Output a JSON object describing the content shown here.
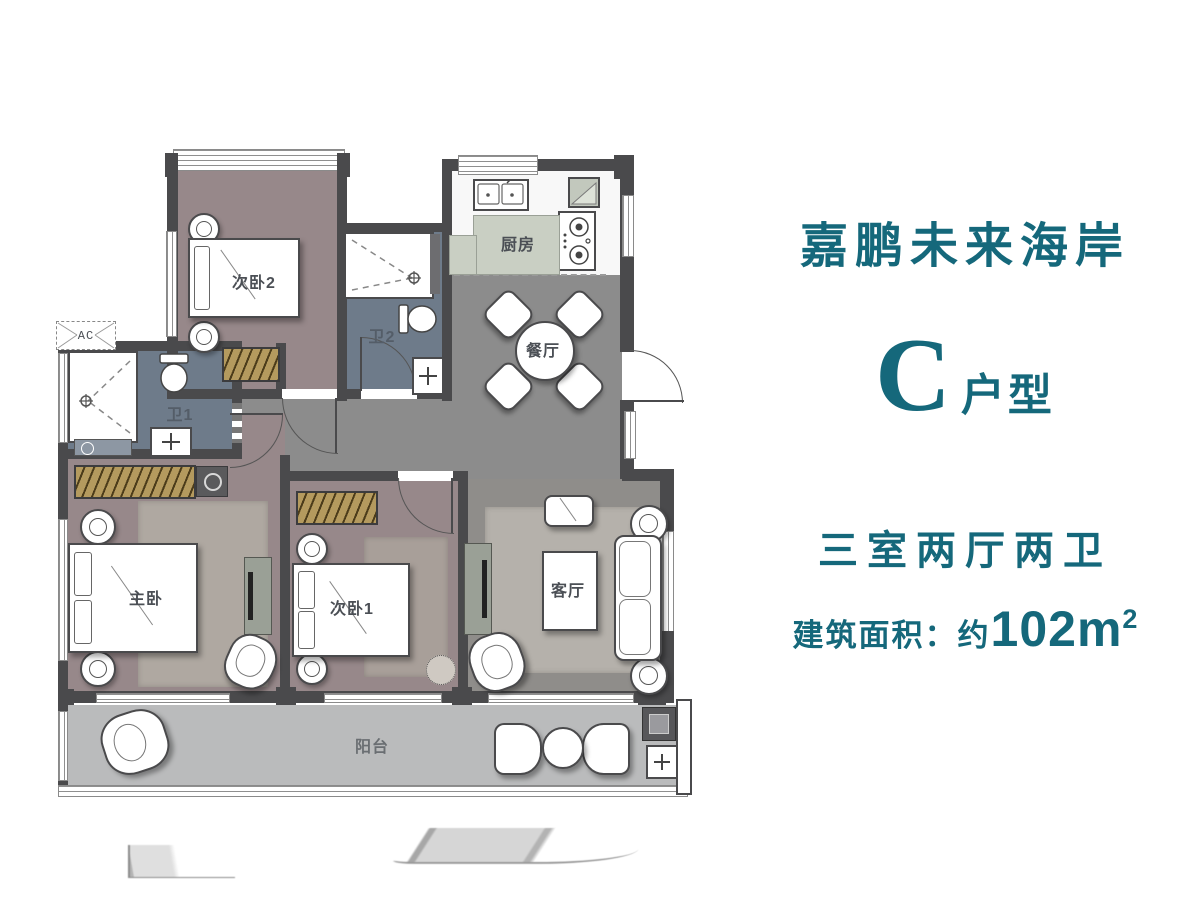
{
  "panel": {
    "project_name": "嘉鹏未来海岸",
    "unit_letter": "C",
    "unit_suffix": "户型",
    "layout_summary": "三室两厅两卫",
    "area_prefix": "建筑面积：约",
    "area_value": "102m",
    "area_sup": "2"
  },
  "rooms": {
    "bedroom2": "次卧2",
    "bath2": "卫2",
    "kitchen": "厨房",
    "dining": "餐厅",
    "bath1": "卫1",
    "master": "主卧",
    "bedroom1": "次卧1",
    "living": "客厅",
    "balcony": "阳台",
    "ac": "AC"
  },
  "colors": {
    "accent_teal": "#15687B",
    "wall": "#4A4A4C",
    "bedroom_floor": "#97888A",
    "corridor_floor": "#8C8C8C",
    "bath_floor": "#6E7B8A",
    "kitchen_counter": "#C9CFC3",
    "balcony_floor": "#BABBBC",
    "wardrobe": "#B49A5E",
    "rug": "#B5B1AB"
  }
}
